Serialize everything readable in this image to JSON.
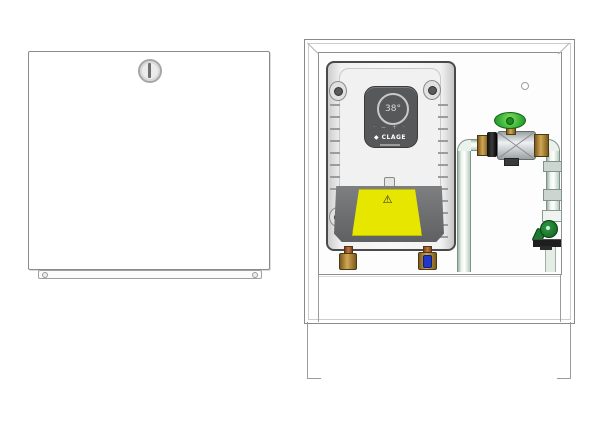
{
  "illustration": {
    "description": "Technical product drawing of a built-in instantaneous water heater: closed cabinet front panel (left) and open installation box with heater and shut-off valve (right)"
  },
  "heater": {
    "brand_label": "◆ CLAGE",
    "display_value": "38°",
    "button_glyphs": "· − + ·",
    "warning_glyph": "⚠"
  },
  "colors": {
    "outline_gray": "#8a8a8a",
    "heater_body": "#f1f1f1",
    "control_panel_dark": "#56585a",
    "warning_label_yellow": "#e6e600",
    "valve_handle_green": "#3db53d",
    "outlet_valve_dark_green": "#1a7a2e",
    "brass": "#d2a855",
    "copper": "#c07a3e",
    "cold_water_blue": "#2038c8",
    "pipe_pale_green": "#eef6ef"
  }
}
